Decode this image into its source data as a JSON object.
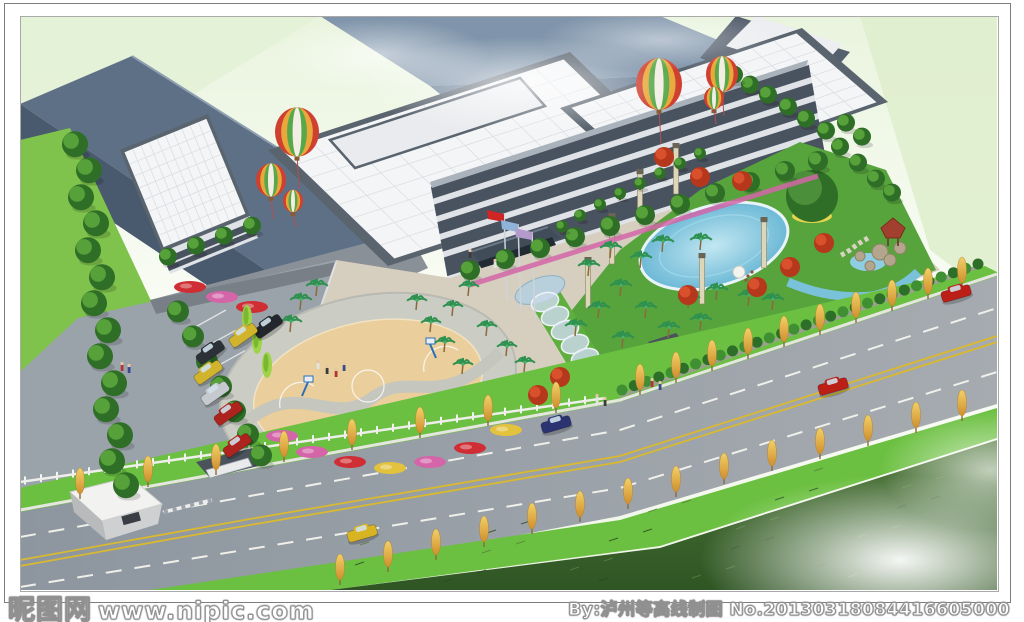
{
  "watermarks": {
    "left_logo": "昵图网",
    "left_url": "www.nipic.com",
    "right": "By:泸州等高线制图  No.20130318084416605000"
  },
  "palette": {
    "bg_top": "#e9f4de",
    "bg_mid": "#fbfdf8",
    "pale_green": "#ddeecb",
    "roof_white": "#f4f5f7",
    "roof_grid": "#d9dce0",
    "parapet": "#5a646f",
    "roof_slate": "#5e7085",
    "roof_slate_dark": "#49596e",
    "wall_gray": "#8a9097",
    "back_slope": "#8095ab",
    "facade_light": "#dfe3e7",
    "facade_dark": "#49525f",
    "parking": "#9ba3aa",
    "plaza": "#d6cfbf",
    "court_tan": "#eace9c",
    "court_ring": "#cbccc4",
    "grass": "#7fc24c",
    "verge": "#6cc041",
    "field_dark": "#2f5524",
    "field_lit": "#4c7637",
    "road": "#949ca5",
    "lane_yellow": "#d9b92f",
    "lane_white": "#f0f0ea",
    "pool_blue": "#6db9d6",
    "stream_blue": "#7ac2da",
    "tree_green": "#2f6e27",
    "tree_light": "#57a13a",
    "palm_green": "#2f9150",
    "maple_red": "#b5371c",
    "yellow_tree": "#e6b93f",
    "cypress": "#9ed34a",
    "flower_pink": "#d465a8",
    "flower_red": "#cf2e35",
    "banner_red": "#c22a22",
    "flag_red": "#cf2525",
    "flag_blue": "#8fb3d9",
    "flag_purple": "#b49aca",
    "gazebo": "#a1402e",
    "rock": "#b3a68d"
  },
  "scene": {
    "balloons": [
      [
        297,
        132,
        22
      ],
      [
        271,
        180,
        15
      ],
      [
        293,
        201,
        10
      ],
      [
        659,
        84,
        23
      ],
      [
        722,
        74,
        16
      ],
      [
        714,
        98,
        10
      ]
    ],
    "left_trees": [
      [
        75,
        152
      ],
      [
        89,
        178
      ],
      [
        81,
        205
      ],
      [
        96,
        231
      ],
      [
        88,
        258
      ],
      [
        102,
        285
      ],
      [
        94,
        311
      ],
      [
        108,
        338
      ],
      [
        100,
        364
      ],
      [
        114,
        391
      ],
      [
        106,
        417
      ],
      [
        120,
        443
      ],
      [
        112,
        469
      ],
      [
        126,
        493
      ]
    ],
    "drive_trees": [
      [
        178,
        318
      ],
      [
        193,
        343
      ],
      [
        207,
        368
      ],
      [
        221,
        393
      ],
      [
        235,
        418
      ],
      [
        248,
        441
      ],
      [
        261,
        462
      ]
    ],
    "facade_trees": [
      [
        470,
        276
      ],
      [
        505,
        265
      ],
      [
        540,
        254
      ],
      [
        575,
        243
      ],
      [
        610,
        232
      ],
      [
        645,
        221
      ],
      [
        680,
        210
      ],
      [
        715,
        199
      ],
      [
        750,
        188
      ],
      [
        785,
        177
      ],
      [
        818,
        167
      ]
    ],
    "annex_trees": [
      [
        168,
        262
      ],
      [
        196,
        251
      ],
      [
        224,
        241
      ],
      [
        252,
        231
      ]
    ],
    "annex_flowers": [
      [
        190,
        287
      ],
      [
        222,
        297
      ],
      [
        252,
        307
      ]
    ],
    "garden_palms": [
      [
        598,
        318
      ],
      [
        575,
        336
      ],
      [
        620,
        296
      ],
      [
        645,
        318
      ],
      [
        668,
        338
      ],
      [
        688,
        308
      ],
      [
        640,
        268
      ],
      [
        610,
        258
      ],
      [
        588,
        276
      ],
      [
        662,
        252
      ],
      [
        700,
        250
      ],
      [
        716,
        300
      ],
      [
        748,
        306
      ],
      [
        772,
        310
      ],
      [
        700,
        330
      ],
      [
        622,
        348
      ]
    ],
    "walk_palms": [
      [
        468,
        296
      ],
      [
        452,
        316
      ],
      [
        486,
        336
      ],
      [
        506,
        356
      ],
      [
        524,
        372
      ],
      [
        444,
        352
      ],
      [
        462,
        374
      ],
      [
        430,
        332
      ],
      [
        416,
        310
      ]
    ],
    "plaza_palms": [
      [
        300,
        310
      ],
      [
        290,
        332
      ],
      [
        316,
        296
      ]
    ],
    "maples": [
      [
        757,
        292
      ],
      [
        790,
        272
      ],
      [
        700,
        182
      ],
      [
        664,
        162
      ],
      [
        742,
        186
      ],
      [
        688,
        300
      ],
      [
        824,
        248
      ],
      [
        538,
        400
      ],
      [
        560,
        382
      ]
    ],
    "garden_greens": [
      [
        840,
        152
      ],
      [
        858,
        168
      ],
      [
        876,
        184
      ],
      [
        892,
        198
      ],
      [
        846,
        128
      ],
      [
        862,
        142
      ],
      [
        826,
        136
      ],
      [
        806,
        124
      ],
      [
        788,
        112
      ],
      [
        768,
        100
      ],
      [
        750,
        90
      ],
      [
        734,
        80
      ]
    ],
    "terrace_shrubs": [
      [
        600,
        208
      ],
      [
        620,
        197
      ],
      [
        640,
        187
      ],
      [
        660,
        177
      ],
      [
        680,
        167
      ],
      [
        700,
        157
      ],
      [
        580,
        219
      ],
      [
        562,
        230
      ]
    ],
    "big_tree": [
      812,
      196
    ],
    "cypresses": [
      [
        247,
        330
      ],
      [
        257,
        353
      ],
      [
        267,
        377
      ]
    ],
    "court_flowers": [
      [
        312,
        452
      ],
      [
        350,
        462
      ],
      [
        390,
        468
      ],
      [
        430,
        462
      ],
      [
        470,
        448
      ],
      [
        506,
        430
      ],
      [
        282,
        436
      ]
    ],
    "lamps": [
      [
        612,
        262
      ],
      [
        640,
        218
      ],
      [
        676,
        192
      ],
      [
        702,
        302
      ],
      [
        764,
        266
      ],
      [
        588,
        306
      ]
    ],
    "far_verge_trees": [
      [
        80,
        499
      ],
      [
        148,
        487
      ],
      [
        216,
        475
      ],
      [
        284,
        462
      ],
      [
        352,
        450
      ],
      [
        420,
        438
      ],
      [
        488,
        426
      ],
      [
        556,
        413
      ],
      [
        640,
        395
      ],
      [
        676,
        383
      ],
      [
        712,
        371
      ],
      [
        748,
        359
      ],
      [
        784,
        347
      ],
      [
        820,
        335
      ],
      [
        856,
        323
      ],
      [
        892,
        311
      ],
      [
        928,
        299
      ],
      [
        962,
        288
      ]
    ],
    "near_verge_trees": [
      [
        340,
        585
      ],
      [
        388,
        572
      ],
      [
        436,
        560
      ],
      [
        484,
        547
      ],
      [
        532,
        534
      ],
      [
        580,
        522
      ],
      [
        628,
        509
      ],
      [
        676,
        497
      ],
      [
        724,
        484
      ],
      [
        772,
        471
      ],
      [
        820,
        459
      ],
      [
        868,
        446
      ],
      [
        916,
        433
      ],
      [
        962,
        421
      ]
    ],
    "park_cars": [
      [
        268,
        326,
        "#23262c"
      ],
      [
        243,
        335,
        "#d2b42c"
      ],
      [
        210,
        352,
        "#2c3138"
      ],
      [
        208,
        372,
        "#d2b42c"
      ],
      [
        215,
        393,
        "#c6cacf"
      ],
      [
        228,
        413,
        "#ad241e"
      ],
      [
        237,
        445,
        "#ad241e"
      ]
    ],
    "road_cars": [
      [
        362,
        533,
        "#d9b422"
      ],
      [
        556,
        424,
        "#2b3470"
      ],
      [
        833,
        386,
        "#bb1f16"
      ],
      [
        956,
        293,
        "#bb1f16"
      ]
    ],
    "people": [
      [
        122,
        371
      ],
      [
        129,
        373
      ],
      [
        318,
        369
      ],
      [
        327,
        374
      ],
      [
        336,
        377
      ],
      [
        344,
        371
      ],
      [
        597,
        403
      ],
      [
        605,
        406
      ],
      [
        652,
        387
      ],
      [
        660,
        390
      ],
      [
        495,
        268
      ],
      [
        470,
        258
      ]
    ],
    "arches": [
      [
        545,
        302
      ],
      [
        555,
        316
      ],
      [
        565,
        330
      ],
      [
        575,
        344
      ],
      [
        585,
        358
      ],
      [
        594,
        371
      ]
    ],
    "flags": [
      [
        504,
        214,
        "#cf2525"
      ],
      [
        518,
        224,
        "#8fb3d9"
      ],
      [
        532,
        232,
        "#b49aca"
      ]
    ]
  }
}
